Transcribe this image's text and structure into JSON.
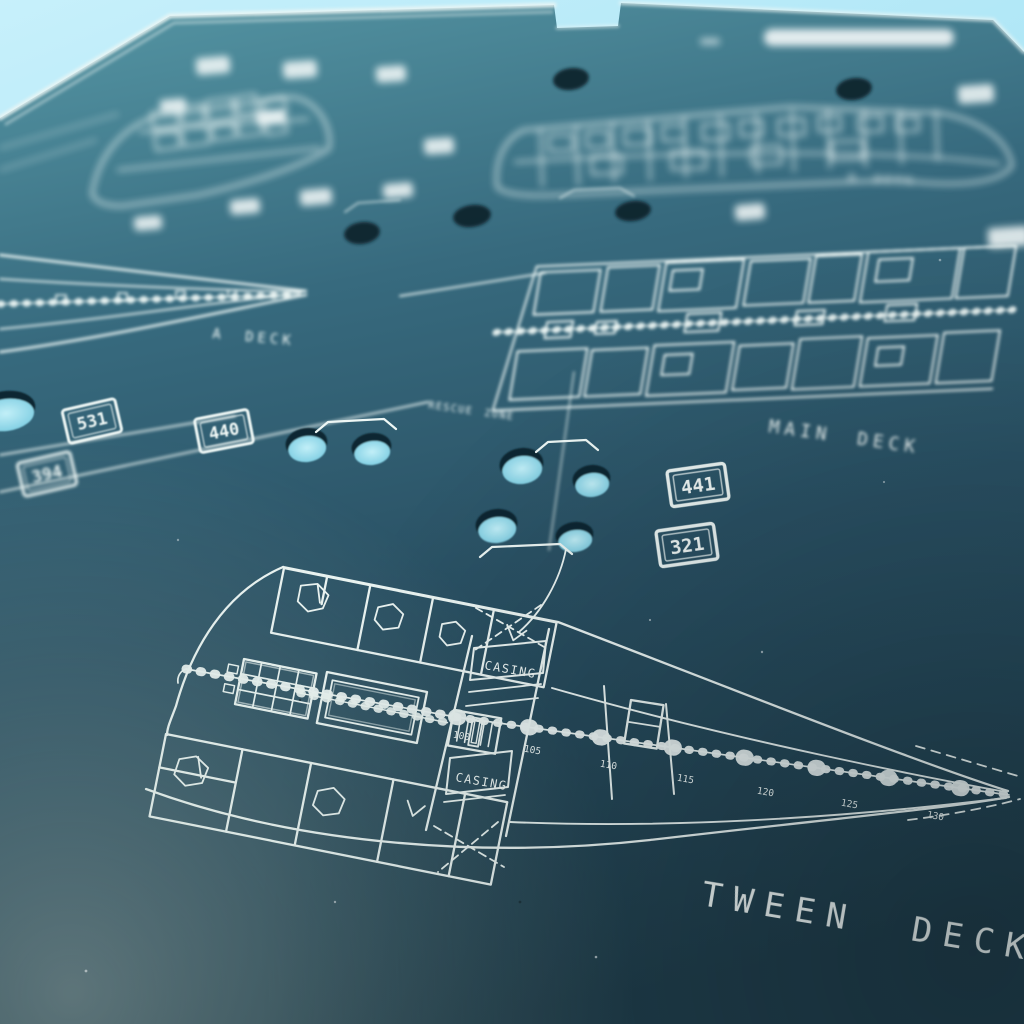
{
  "deck_labels": {
    "tween": "TWEEN DECK",
    "main": "MAIN DECK",
    "a": "A DECK",
    "b": "B DECK"
  },
  "annotations": {
    "rescue_zone": "RESCUE ZONE",
    "casing_upper": "CASING",
    "casing_lower": "CASING"
  },
  "badges": [
    {
      "value": "531"
    },
    {
      "value": "440"
    },
    {
      "value": "394"
    },
    {
      "value": "441"
    },
    {
      "value": "321"
    }
  ],
  "frame_numbers": [
    "100",
    "105",
    "110",
    "115",
    "120",
    "125",
    "130"
  ],
  "colors": {
    "background_sky": "#aee6f6",
    "plate_top": "#4f8ea3",
    "plate_mid": "#2e5d73",
    "plate_bottom": "#203d4a",
    "engraving": "#eef7f5",
    "hole_cyan": "#8fd8e8"
  }
}
